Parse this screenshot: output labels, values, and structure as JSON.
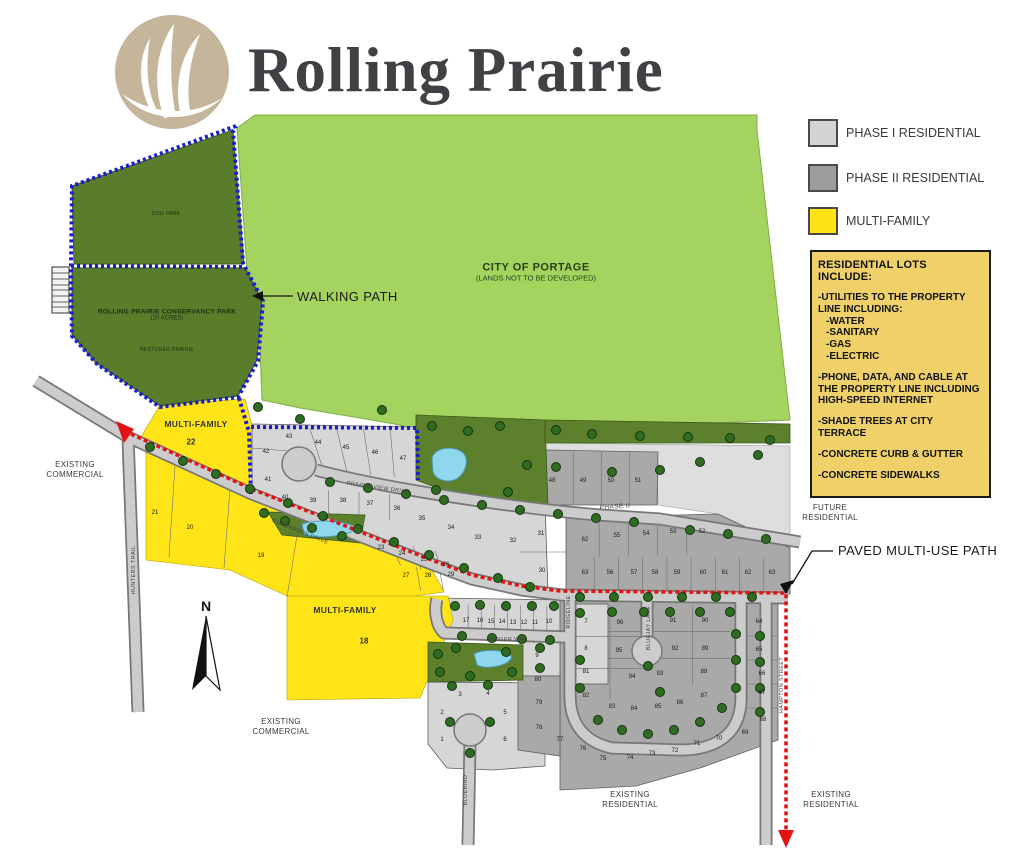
{
  "logo": {
    "title": "Rolling Prairie"
  },
  "legend": {
    "items": [
      {
        "id": "phase1",
        "label": "PHASE I RESIDENTIAL",
        "color": "#d3d3d3",
        "y": 118
      },
      {
        "id": "phase2",
        "label": "PHASE II RESIDENTIAL",
        "color": "#9c9c9c",
        "y": 163
      },
      {
        "id": "multifamily",
        "label": "MULTI-FAMILY",
        "color": "#ffe415",
        "y": 206
      }
    ]
  },
  "info_box": {
    "title": "RESIDENTIAL LOTS INCLUDE:",
    "sections": [
      {
        "text": "-UTILITIES TO THE PROPERTY LINE INCLUDING:",
        "sub": [
          "-WATER",
          "-SANITARY",
          "-GAS",
          "-ELECTRIC"
        ]
      },
      {
        "text": "-PHONE, DATA, AND CABLE AT THE PROPERTY LINE INCLUDING HIGH-SPEED INTERNET",
        "sub": []
      },
      {
        "text": "-SHADE TREES AT CITY TERRACE",
        "sub": []
      },
      {
        "text": "-CONCRETE CURB & GUTTER",
        "sub": []
      },
      {
        "text": "-CONCRETE SIDEWALKS",
        "sub": []
      }
    ]
  },
  "map": {
    "annotations": {
      "walking_path": "WALKING PATH",
      "paved_path": "PAVED MULTI-USE PATH",
      "north": "N"
    },
    "labels": [
      {
        "id": "city-of-portage",
        "x": 536,
        "y": 272,
        "cls": "c-city",
        "rot": 0,
        "lines": [
          "CITY OF PORTAGE",
          "(LANDS NOT TO BE DEVELOPED)"
        ]
      },
      {
        "id": "dog-park",
        "x": 166,
        "y": 214,
        "cls": "c-tiny",
        "rot": 0,
        "lines": [
          "DOG PARK"
        ]
      },
      {
        "id": "conservancy-park",
        "x": 167,
        "y": 315,
        "cls": "c-small",
        "rot": 0,
        "lines": [
          "ROLLING PRAIRIE CONSERVANCY PARK",
          "(20 ACRES)"
        ]
      },
      {
        "id": "restored-prairie",
        "x": 167,
        "y": 350,
        "cls": "c-tiny",
        "rot": 0,
        "lines": [
          "RESTORED PRAIRIE"
        ]
      },
      {
        "id": "multi-family-22-label",
        "x": 196,
        "y": 424,
        "cls": "c-mf",
        "rot": 0,
        "lines": [
          "MULTI-FAMILY"
        ]
      },
      {
        "id": "multi-family-22-num",
        "x": 191,
        "y": 442,
        "cls": "c-mfnum",
        "rot": 0,
        "lines": [
          "22"
        ]
      },
      {
        "id": "multi-family-18-label",
        "x": 345,
        "y": 610,
        "cls": "c-mf",
        "rot": 0,
        "lines": [
          "MULTI-FAMILY"
        ]
      },
      {
        "id": "multi-family-18-num",
        "x": 364,
        "y": 641,
        "cls": "c-mfnum",
        "rot": 0,
        "lines": [
          "18"
        ]
      },
      {
        "id": "existing-commercial-nw",
        "x": 75,
        "y": 470,
        "cls": "c-zone",
        "rot": 0,
        "lines": [
          "EXISTING",
          "COMMERCIAL"
        ]
      },
      {
        "id": "existing-commercial-s",
        "x": 281,
        "y": 727,
        "cls": "c-zone",
        "rot": 0,
        "lines": [
          "EXISTING",
          "COMMERCIAL"
        ]
      },
      {
        "id": "existing-residential-c",
        "x": 630,
        "y": 800,
        "cls": "c-zone",
        "rot": 0,
        "lines": [
          "EXISTING",
          "RESIDENTIAL"
        ]
      },
      {
        "id": "existing-residential-e",
        "x": 831,
        "y": 800,
        "cls": "c-zone",
        "rot": 0,
        "lines": [
          "EXISTING",
          "RESIDENTIAL"
        ]
      },
      {
        "id": "future-residential",
        "x": 830,
        "y": 513,
        "cls": "c-zone",
        "rot": 0,
        "lines": [
          "FUTURE",
          "RESIDENTIAL"
        ]
      },
      {
        "id": "phase-ii-road",
        "x": 615,
        "y": 507,
        "cls": "c-phase",
        "rot": -3,
        "lines": [
          "PHASE II"
        ]
      }
    ],
    "roads": [
      {
        "name": "PRAIRIE VIEW DRIVE",
        "x": 378,
        "y": 488,
        "rot": 8
      },
      {
        "name": "GUNDERSON DRIVE",
        "x": 300,
        "y": 532,
        "rot": 22
      },
      {
        "name": "BADGER WAY",
        "x": 507,
        "y": 640,
        "rot": 0
      },
      {
        "name": "HUNTERS TRAIL",
        "x": 134,
        "y": 570,
        "rot": -90
      },
      {
        "name": "RIDGELINE",
        "x": 569,
        "y": 612,
        "rot": -90
      },
      {
        "name": "BLUEJAY LANE",
        "x": 649,
        "y": 628,
        "rot": -90
      },
      {
        "name": "HAMPTON STREET",
        "x": 782,
        "y": 685,
        "rot": -90
      },
      {
        "name": "BLUEBIRD",
        "x": 466,
        "y": 790,
        "rot": -90
      }
    ],
    "lots": [
      {
        "n": "42",
        "x": 266,
        "y": 452
      },
      {
        "n": "43",
        "x": 289,
        "y": 437
      },
      {
        "n": "44",
        "x": 318,
        "y": 443
      },
      {
        "n": "45",
        "x": 346,
        "y": 448
      },
      {
        "n": "46",
        "x": 375,
        "y": 453
      },
      {
        "n": "47",
        "x": 403,
        "y": 459
      },
      {
        "n": "41",
        "x": 268,
        "y": 480
      },
      {
        "n": "40",
        "x": 285,
        "y": 498
      },
      {
        "n": "39",
        "x": 313,
        "y": 501
      },
      {
        "n": "38",
        "x": 343,
        "y": 501
      },
      {
        "n": "37",
        "x": 370,
        "y": 504
      },
      {
        "n": "36",
        "x": 397,
        "y": 509
      },
      {
        "n": "35",
        "x": 422,
        "y": 519
      },
      {
        "n": "34",
        "x": 451,
        "y": 528
      },
      {
        "n": "33",
        "x": 478,
        "y": 538
      },
      {
        "n": "32",
        "x": 513,
        "y": 541
      },
      {
        "n": "23",
        "x": 381,
        "y": 548
      },
      {
        "n": "24",
        "x": 402,
        "y": 554
      },
      {
        "n": "25",
        "x": 424,
        "y": 560
      },
      {
        "n": "26",
        "x": 446,
        "y": 565
      },
      {
        "n": "27",
        "x": 406,
        "y": 576
      },
      {
        "n": "28",
        "x": 428,
        "y": 576
      },
      {
        "n": "29",
        "x": 451,
        "y": 575
      },
      {
        "n": "30",
        "x": 542,
        "y": 571
      },
      {
        "n": "31",
        "x": 541,
        "y": 534
      },
      {
        "n": "21",
        "x": 155,
        "y": 513
      },
      {
        "n": "20",
        "x": 190,
        "y": 528
      },
      {
        "n": "19",
        "x": 261,
        "y": 556
      },
      {
        "n": "17",
        "x": 466,
        "y": 621
      },
      {
        "n": "16",
        "x": 480,
        "y": 621
      },
      {
        "n": "15",
        "x": 491,
        "y": 622
      },
      {
        "n": "14",
        "x": 502,
        "y": 622
      },
      {
        "n": "13",
        "x": 513,
        "y": 623
      },
      {
        "n": "12",
        "x": 524,
        "y": 623
      },
      {
        "n": "11",
        "x": 535,
        "y": 623
      },
      {
        "n": "10",
        "x": 549,
        "y": 622
      },
      {
        "n": "9",
        "x": 537,
        "y": 656
      },
      {
        "n": "3",
        "x": 460,
        "y": 695
      },
      {
        "n": "4",
        "x": 488,
        "y": 694
      },
      {
        "n": "2",
        "x": 442,
        "y": 713
      },
      {
        "n": "5",
        "x": 505,
        "y": 713
      },
      {
        "n": "1",
        "x": 442,
        "y": 740
      },
      {
        "n": "6",
        "x": 505,
        "y": 740
      },
      {
        "n": "7",
        "x": 586,
        "y": 622
      },
      {
        "n": "8",
        "x": 586,
        "y": 649
      },
      {
        "n": "48",
        "x": 552,
        "y": 481
      },
      {
        "n": "49",
        "x": 583,
        "y": 481
      },
      {
        "n": "50",
        "x": 611,
        "y": 481
      },
      {
        "n": "51",
        "x": 638,
        "y": 481
      },
      {
        "n": "62",
        "x": 585,
        "y": 540
      },
      {
        "n": "55",
        "x": 617,
        "y": 536
      },
      {
        "n": "54",
        "x": 646,
        "y": 534
      },
      {
        "n": "53",
        "x": 673,
        "y": 532
      },
      {
        "n": "52",
        "x": 702,
        "y": 532
      },
      {
        "n": "63",
        "x": 585,
        "y": 573
      },
      {
        "n": "56",
        "x": 610,
        "y": 573
      },
      {
        "n": "57",
        "x": 634,
        "y": 573
      },
      {
        "n": "58",
        "x": 655,
        "y": 573
      },
      {
        "n": "59",
        "x": 677,
        "y": 573
      },
      {
        "n": "60",
        "x": 703,
        "y": 573
      },
      {
        "n": "61",
        "x": 725,
        "y": 573
      },
      {
        "n": "62",
        "x": 748,
        "y": 573
      },
      {
        "n": "63",
        "x": 772,
        "y": 573
      },
      {
        "n": "96",
        "x": 620,
        "y": 623
      },
      {
        "n": "95",
        "x": 619,
        "y": 651
      },
      {
        "n": "91",
        "x": 673,
        "y": 621
      },
      {
        "n": "90",
        "x": 705,
        "y": 621
      },
      {
        "n": "92",
        "x": 675,
        "y": 649
      },
      {
        "n": "89",
        "x": 705,
        "y": 649
      },
      {
        "n": "94",
        "x": 632,
        "y": 677
      },
      {
        "n": "93",
        "x": 660,
        "y": 674
      },
      {
        "n": "88",
        "x": 704,
        "y": 672
      },
      {
        "n": "81",
        "x": 586,
        "y": 672
      },
      {
        "n": "82",
        "x": 586,
        "y": 696
      },
      {
        "n": "83",
        "x": 612,
        "y": 707
      },
      {
        "n": "84",
        "x": 634,
        "y": 709
      },
      {
        "n": "85",
        "x": 658,
        "y": 707
      },
      {
        "n": "86",
        "x": 680,
        "y": 703
      },
      {
        "n": "87",
        "x": 704,
        "y": 696
      },
      {
        "n": "64",
        "x": 759,
        "y": 622
      },
      {
        "n": "65",
        "x": 759,
        "y": 650
      },
      {
        "n": "66",
        "x": 762,
        "y": 674
      },
      {
        "n": "67",
        "x": 762,
        "y": 693
      },
      {
        "n": "68",
        "x": 763,
        "y": 720
      },
      {
        "n": "80",
        "x": 538,
        "y": 680
      },
      {
        "n": "79",
        "x": 539,
        "y": 703
      },
      {
        "n": "78",
        "x": 539,
        "y": 728
      },
      {
        "n": "77",
        "x": 560,
        "y": 740
      },
      {
        "n": "76",
        "x": 583,
        "y": 749
      },
      {
        "n": "75",
        "x": 603,
        "y": 759
      },
      {
        "n": "74",
        "x": 630,
        "y": 758
      },
      {
        "n": "73",
        "x": 652,
        "y": 754
      },
      {
        "n": "72",
        "x": 675,
        "y": 751
      },
      {
        "n": "71",
        "x": 697,
        "y": 744
      },
      {
        "n": "70",
        "x": 719,
        "y": 739
      },
      {
        "n": "69",
        "x": 745,
        "y": 733
      }
    ]
  }
}
